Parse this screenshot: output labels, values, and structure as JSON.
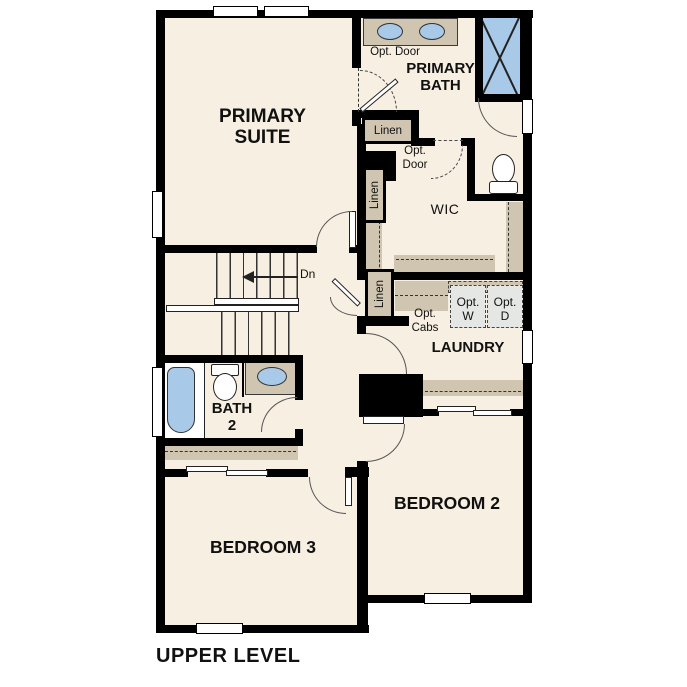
{
  "title": "UPPER LEVEL",
  "rooms": {
    "primary_suite": "PRIMARY\nSUITE",
    "primary_bath": "PRIMARY\nBATH",
    "wic": "WIC",
    "laundry": "LAUNDRY",
    "bath_2": "BATH\n2",
    "bedroom_2": "BEDROOM 2",
    "bedroom_3": "BEDROOM 3"
  },
  "annotations": {
    "opt_door_bath": "Opt. Door",
    "opt_door_wic": "Opt.\nDoor",
    "linen_bath": "Linen",
    "linen_wic": "Linen",
    "linen_hall": "Linen",
    "opt_cabs": "Opt.\nCabs",
    "opt_washer": "Opt.\nW",
    "opt_dryer": "Opt.\nD",
    "stair_direction": "Dn"
  },
  "colors": {
    "wall": "#000000",
    "floor": "#f7efe2",
    "cabinet": "#cfc5b1",
    "fixture_blue": "#a9c9e8",
    "appliance_gray": "#e5e7e4"
  }
}
